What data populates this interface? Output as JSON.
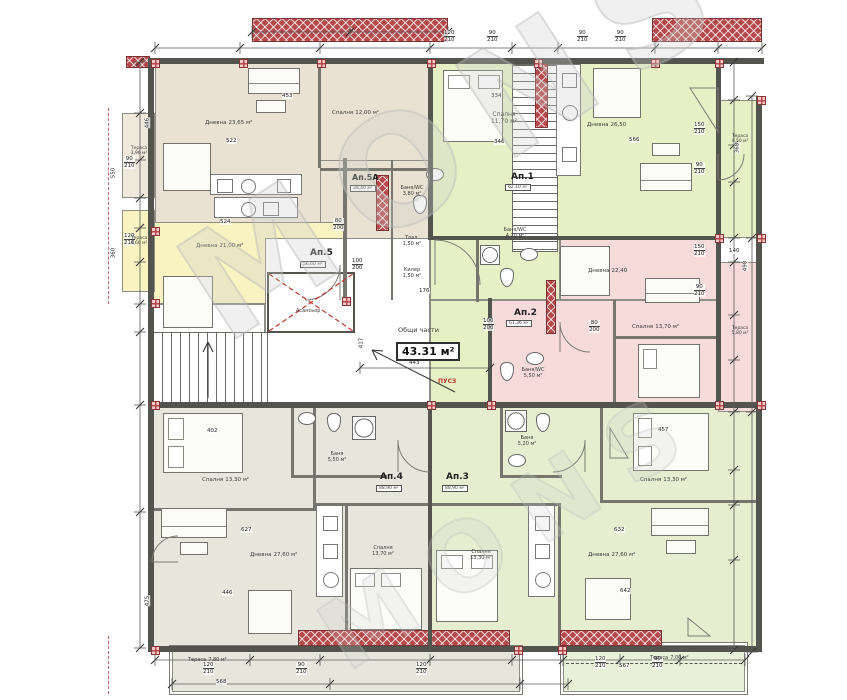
{
  "watermark": {
    "text": "MONS"
  },
  "common_area": {
    "label": "Общи части",
    "area": "43.31 м²",
    "elevator_label": "Асансьор",
    "red_note": "ПУСЗ"
  },
  "apartments": [
    {
      "label": "Ап.1",
      "area": "62,10 м²"
    },
    {
      "label": "Ап.2",
      "area": "61,36 м²"
    },
    {
      "label": "Ап.3",
      "area": "88,90 м²"
    },
    {
      "label": "Ап.4",
      "area": "88,90 м²"
    },
    {
      "label": "Ап.5",
      "area": "56,60 м²"
    },
    {
      "label": "Ап.5А",
      "area": "38,40 м²"
    }
  ],
  "rooms": [
    {
      "name": "Дневна",
      "area": "23,65 м²"
    },
    {
      "name": "Спалня",
      "area": "12,00 м²"
    },
    {
      "name": "Дневна",
      "area": "21,00 м²"
    },
    {
      "name": "Баня/WC",
      "area": "3,80 м²"
    },
    {
      "name": "Тоал.",
      "area": "1,50 м²"
    },
    {
      "name": "Килер",
      "area": "1,50 м²"
    },
    {
      "name": "Спалня",
      "area": "11,70 м²"
    },
    {
      "name": "Дневна",
      "area": "26,50"
    },
    {
      "name": "Баня/WC",
      "area": "4,20 м²"
    },
    {
      "name": "Дневна",
      "area": "22,40"
    },
    {
      "name": "Спалня",
      "area": "13,70 м²"
    },
    {
      "name": "Баня/WC",
      "area": "5,50 м²"
    },
    {
      "name": "Спалня",
      "area": "13,30 м²"
    },
    {
      "name": "Баня",
      "area": "5,50 м²"
    },
    {
      "name": "Дневна",
      "area": "27,60 м²"
    },
    {
      "name": "Спалня",
      "area": "13,70 м²"
    },
    {
      "name": "Спалня",
      "area": "13,30 м²"
    },
    {
      "name": "Баня",
      "area": "5,20 м²"
    },
    {
      "name": "Дневна",
      "area": "27,60 м²"
    },
    {
      "name": "Спалня",
      "area": "13,30 м²"
    },
    {
      "name": "Тераса",
      "area": "3,96 м²"
    },
    {
      "name": "Тераса",
      "area": "4,60 м²"
    },
    {
      "name": "Тераса",
      "area": "4,50 м²"
    },
    {
      "name": "Тераса",
      "area": "5,80 м²"
    },
    {
      "name": "Тераса",
      "area": "7,80 м²"
    },
    {
      "name": "Тераса",
      "area": "7,00 м²"
    }
  ],
  "dims": {
    "pairs": [
      [
        "120",
        "210"
      ],
      [
        "90",
        "210"
      ],
      [
        "90",
        "210"
      ],
      [
        "90",
        "210"
      ],
      [
        "150",
        "210"
      ],
      [
        "90",
        "210"
      ],
      [
        "150",
        "210"
      ],
      [
        "90",
        "210"
      ],
      [
        "100",
        "200"
      ],
      [
        "80",
        "200"
      ],
      [
        "100",
        "200"
      ],
      [
        "80",
        "200"
      ],
      [
        "90",
        "210"
      ],
      [
        "120",
        "210"
      ],
      [
        "120",
        "210"
      ],
      [
        "90",
        "210"
      ],
      [
        "120",
        "210"
      ],
      [
        "120",
        "210"
      ],
      [
        "90",
        "210"
      ]
    ],
    "values": [
      "522",
      "453",
      "334",
      "346",
      "566",
      "443",
      "176",
      "627",
      "632",
      "457",
      "402",
      "524",
      "568",
      "446",
      "642",
      "567",
      "498",
      "368",
      "140",
      "550",
      "360",
      "446",
      "417",
      "475"
    ]
  }
}
